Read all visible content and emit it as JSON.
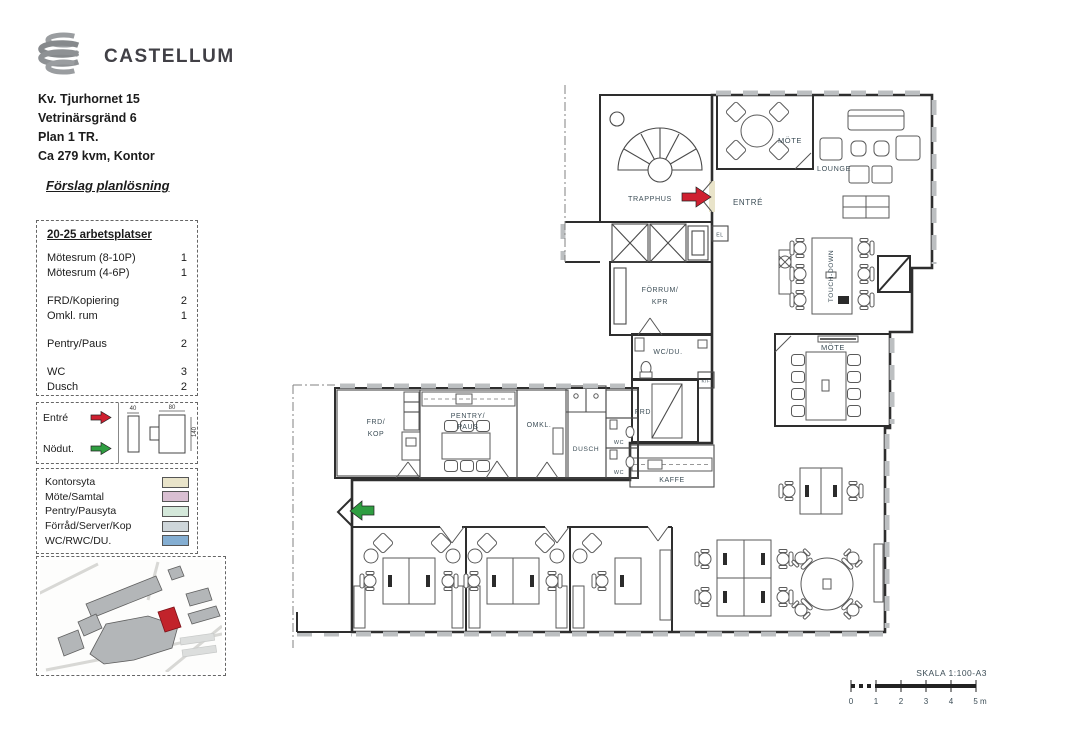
{
  "header": {
    "logo_text": "CASTELLUM",
    "address_line1": "Kv. Tjurhornet 15",
    "address_line2": "Vetrinärsgränd 6",
    "address_line3": "Plan 1 TR.",
    "address_line4": "Ca 279 kvm, Kontor",
    "proposal_title": "Förslag planlösning"
  },
  "program": {
    "title": "20-25 arbetsplatser",
    "items": [
      {
        "label": "Mötesrum (8-10P)",
        "count": "1"
      },
      {
        "label": "Mötesrum (4-6P)",
        "count": "1"
      },
      {
        "label": "FRD/Kopiering",
        "count": "2"
      },
      {
        "label": "Omkl. rum",
        "count": "1"
      },
      {
        "label": "Pentry/Paus",
        "count": "2"
      },
      {
        "label": "WC",
        "count": "3"
      },
      {
        "label": "Dusch",
        "count": "2"
      }
    ]
  },
  "symbols": {
    "entre_label": "Entré",
    "nodut_label": "Nödut.",
    "desk_dim_small": "40",
    "desk_dim_width": "80",
    "desk_dim_depth": "140"
  },
  "legend": {
    "items": [
      {
        "label": "Kontorsyta",
        "color": "#e9e4ca"
      },
      {
        "label": "Möte/Samtal",
        "color": "#d9bfd2"
      },
      {
        "label": "Pentry/Pausyta",
        "color": "#d4e8da"
      },
      {
        "label": "Förråd/Server/Kop",
        "color": "#ced6da"
      },
      {
        "label": "WC/RWC/DU.",
        "color": "#84aed2"
      }
    ]
  },
  "plan": {
    "rooms": {
      "trapphus": "TRAPPHUS",
      "entre": "ENTRÉ",
      "mote_top": "MÖTE",
      "lounge": "LOUNGE",
      "el": "EL",
      "forrum_line1": "FÖRRUM/",
      "forrum_line2": "KPR",
      "touch_down": "TOUCH-DOWN",
      "wc_du": "WC/DU.",
      "kf": "K/F",
      "frd": "FRD",
      "kaffe": "KAFFE",
      "mote_large": "MÖTE",
      "frd_kop_line1": "FRD/",
      "frd_kop_line2": "KOP",
      "pentry_line1": "PENTRY/",
      "pentry_line2": "PAUS",
      "omkl": "OMKL.",
      "dusch": "DUSCH",
      "wc_1": "WC",
      "wc_2": "WC"
    },
    "colors": {
      "kontorsyta": "#e9e4ca",
      "mote": "#d9bfd2",
      "pentry": "#d4e8da",
      "forrad": "#ced6da",
      "wc": "#84aed2",
      "entre_arrow": "#cf2030",
      "nodut_arrow": "#2f9e41",
      "site_highlight": "#c2232b"
    }
  },
  "scalebar": {
    "title": "SKALA 1:100-A3",
    "ticks": [
      "0",
      "1",
      "2",
      "3",
      "4",
      "5 m"
    ]
  }
}
